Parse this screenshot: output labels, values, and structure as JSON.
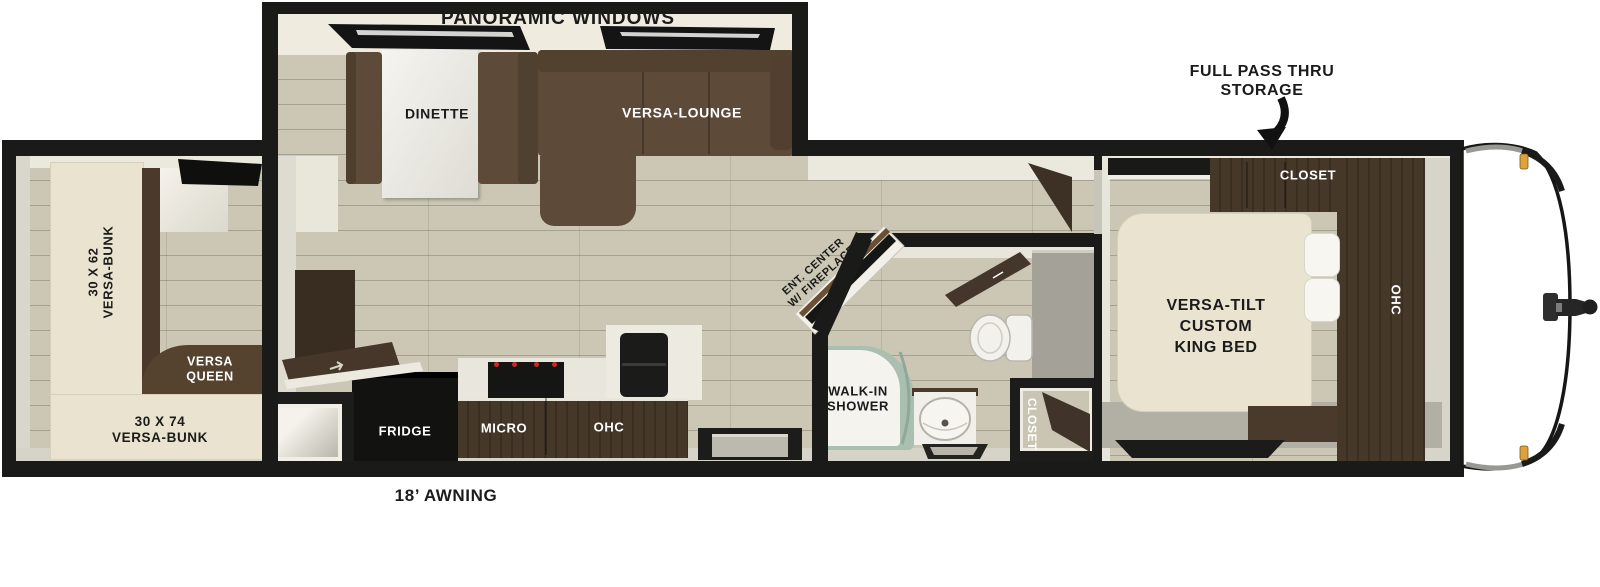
{
  "floorplan": {
    "exterior": {
      "panoramic_windows": "PANORAMIC WINDOWS",
      "storage_line1": "FULL PASS THRU",
      "storage_line2": "STORAGE",
      "awning": "18’ AWNING"
    },
    "bunk_room": {
      "left_bunk_line1": "30 X 62",
      "left_bunk_line2": "VERSA-BUNK",
      "queen_line1": "VERSA",
      "queen_line2": "QUEEN",
      "bottom_bunk_line1": "30 X 74",
      "bottom_bunk_line2": "VERSA-BUNK"
    },
    "living": {
      "dinette": "DINETTE",
      "lounge": "VERSA-LOUNGE",
      "ent_center_line1": "ENT. CENTER",
      "ent_center_line2": "W/ FIREPLACE"
    },
    "kitchen": {
      "fridge": "FRIDGE",
      "micro": "MICRO",
      "ohc": "OHC"
    },
    "bathroom": {
      "shower_line1": "WALK-IN",
      "shower_line2": "SHOWER",
      "closet": "CLOSET"
    },
    "bedroom": {
      "closet": "CLOSET",
      "ohc": "OHC",
      "bed_line1": "VERSA-TILT",
      "bed_line2": "CUSTOM",
      "bed_line3": "KING BED"
    },
    "colors": {
      "wall": "#1a1a18",
      "floor": "#cbc7b4",
      "sofa_brown": "#5d4a38",
      "cabinet_brown": "#463829",
      "mattress_cream": "#e9e3cf",
      "shower_sage": "#a9bfb0",
      "marker_amber": "#dfa13c"
    }
  }
}
